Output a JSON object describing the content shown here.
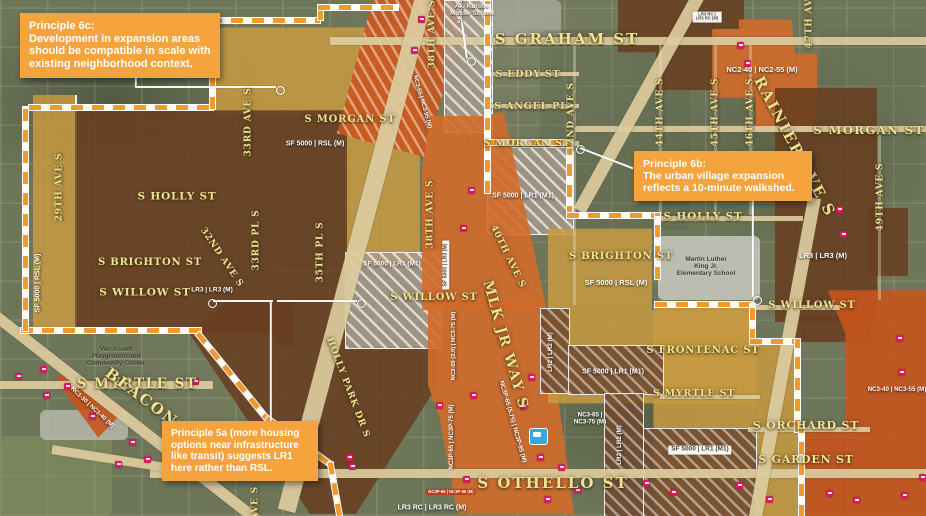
{
  "map_title": "Othello urban village zoning expansion map",
  "colors": {
    "callout_orange": "#F5A33C",
    "zone_gold": "#C79A42",
    "zone_brown": "#6E4526",
    "zone_orange": "#D4702C",
    "zone_deep_orange": "#C9581F",
    "boundary_dash": "#F0992D",
    "transit_stop_icon": "#D81B60",
    "light_rail_icon": "#35A8DC",
    "street_label": "#EFE08F"
  },
  "callouts": [
    {
      "id": "principle-6c",
      "title": "Principle 6c:",
      "body": "Development in expansion areas should be compatible in scale with existing neighborhood context."
    },
    {
      "id": "principle-6b",
      "title": "Principle 6b:",
      "body": "The urban village expansion reflects a 10-minute walkshed."
    },
    {
      "id": "principle-5a",
      "title": "",
      "body": "Principle 5a (more housing options near infrastructure like transit) suggests LR1 here rather than RSL."
    }
  ],
  "street_labels": [
    {
      "id": "graham",
      "text": "S GRAHAM ST"
    },
    {
      "id": "eddy",
      "text": "S EDDY ST"
    },
    {
      "id": "angel",
      "text": "S ANGEL PL"
    },
    {
      "id": "morgan-c",
      "text": "S MORGAN ST"
    },
    {
      "id": "morgan-l",
      "text": "S MORGAN ST"
    },
    {
      "id": "morgan-r",
      "text": "S MORGAN ST"
    },
    {
      "id": "holly-l",
      "text": "S HOLLY ST"
    },
    {
      "id": "holly-r",
      "text": "S HOLLY ST"
    },
    {
      "id": "brighton-l",
      "text": "S BRIGHTON ST"
    },
    {
      "id": "brighton-r",
      "text": "S BRIGHTON ST"
    },
    {
      "id": "willow-l",
      "text": "S WILLOW ST"
    },
    {
      "id": "willow-c",
      "text": "S WILLOW ST"
    },
    {
      "id": "willow-r",
      "text": "S WILLOW ST"
    },
    {
      "id": "myrtle-l",
      "text": "S MYRTLE ST"
    },
    {
      "id": "myrtle-r",
      "text": "S MYRTLE ST"
    },
    {
      "id": "frontenac",
      "text": "S FRONTENAC ST"
    },
    {
      "id": "orchard",
      "text": "S ORCHARD ST"
    },
    {
      "id": "garden",
      "text": "S GARDEN ST"
    },
    {
      "id": "othello",
      "text": "S OTHELLO ST"
    },
    {
      "id": "mlk",
      "text": "MLK JR WAY S"
    },
    {
      "id": "rainier",
      "text": "RAINIER AVE S"
    },
    {
      "id": "beacon",
      "text": "BEACON AVE S"
    },
    {
      "id": "holly-park",
      "text": "HOLLY PARK DR S"
    }
  ],
  "avenue_labels": [
    {
      "id": "29th",
      "text": "29TH AVE S"
    },
    {
      "id": "33rd-ave",
      "text": "33RD AVE S"
    },
    {
      "id": "33rd-pl",
      "text": "33RD PL S"
    },
    {
      "id": "32nd",
      "text": "32ND AVE S"
    },
    {
      "id": "35th",
      "text": "35TH PL S"
    },
    {
      "id": "38th-n",
      "text": "38TH AVE S"
    },
    {
      "id": "38th-s",
      "text": "38TH AVE S"
    },
    {
      "id": "40th",
      "text": "40TH AVE S"
    },
    {
      "id": "42nd",
      "text": "42ND AVE S"
    },
    {
      "id": "44th",
      "text": "44TH AVE S"
    },
    {
      "id": "45th",
      "text": "45TH AVE S"
    },
    {
      "id": "46th",
      "text": "46TH AVE S"
    },
    {
      "id": "47th",
      "text": "47TH AVE S"
    },
    {
      "id": "49th",
      "text": "49TH AVE S"
    },
    {
      "id": "ave-x",
      "text": "AVE S"
    }
  ],
  "zone_labels": [
    {
      "id": "z1",
      "text": "SF 5000 | RSL (M)"
    },
    {
      "id": "z2",
      "text": "SF 5000 | RSL (M)"
    },
    {
      "id": "z3",
      "text": "LR3 | LR3 (M)"
    },
    {
      "id": "z4",
      "text": "LR3 | LR3 (M)"
    },
    {
      "id": "z5",
      "text": "NC2-40 | NC2-55 (M)"
    },
    {
      "id": "z6",
      "text": "LR3 RC |\nLR3 RC (M)"
    },
    {
      "id": "z7",
      "text": "SF 5000 | LR1 (M1)"
    },
    {
      "id": "z8",
      "text": "SF 5000 | LR1 (M1)"
    },
    {
      "id": "z9",
      "text": "SF 5000 | RSL (M)"
    },
    {
      "id": "z10",
      "text": "SF 5000 | LR1 (M1)"
    },
    {
      "id": "z11",
      "text": "SF 5000 | LR1 (M1)"
    },
    {
      "id": "z12",
      "text": "NC3-65 |\nNC3-75 (M)"
    },
    {
      "id": "z13",
      "text": "NC3-40 | NC3-55 (M)"
    },
    {
      "id": "z14",
      "text": "NC1-30 | NC1-40 (M)"
    },
    {
      "id": "z15",
      "text": "LR2 | LR2 (M)"
    },
    {
      "id": "z16",
      "text": "LR2 | LR2 (M)"
    },
    {
      "id": "z17",
      "text": "SF 5000 | LR3 (M)"
    },
    {
      "id": "z18",
      "text": "SF 5000"
    },
    {
      "id": "z19",
      "text": "NC3-65 (2.0) | NC3-75 (M)"
    },
    {
      "id": "z20",
      "text": "NC3P-65 | NC3P-75 (M)"
    },
    {
      "id": "z21",
      "text": "NC3P-65 (5.75) | NC3P-95 (M)"
    },
    {
      "id": "z22",
      "text": "NC3-65 | NC3-95 (M)"
    },
    {
      "id": "z23",
      "text": "NC3P-65 | NC3P-95 (M)"
    },
    {
      "id": "z24",
      "text": "LR3 RC | LR3 RC (M)"
    }
  ],
  "place_labels": [
    {
      "id": "aki",
      "text": "Aki Kurose\nMiddle School"
    },
    {
      "id": "mlk-school",
      "text": "Martin Luther\nKing Jr.\nElementary School"
    },
    {
      "id": "van-asselt",
      "text": "Van Asselt\nPlayground and\nCommunity Center"
    }
  ],
  "icons": {
    "transit_stop": "transit-stop-icon",
    "light_rail_station": "light-rail-station-icon"
  }
}
